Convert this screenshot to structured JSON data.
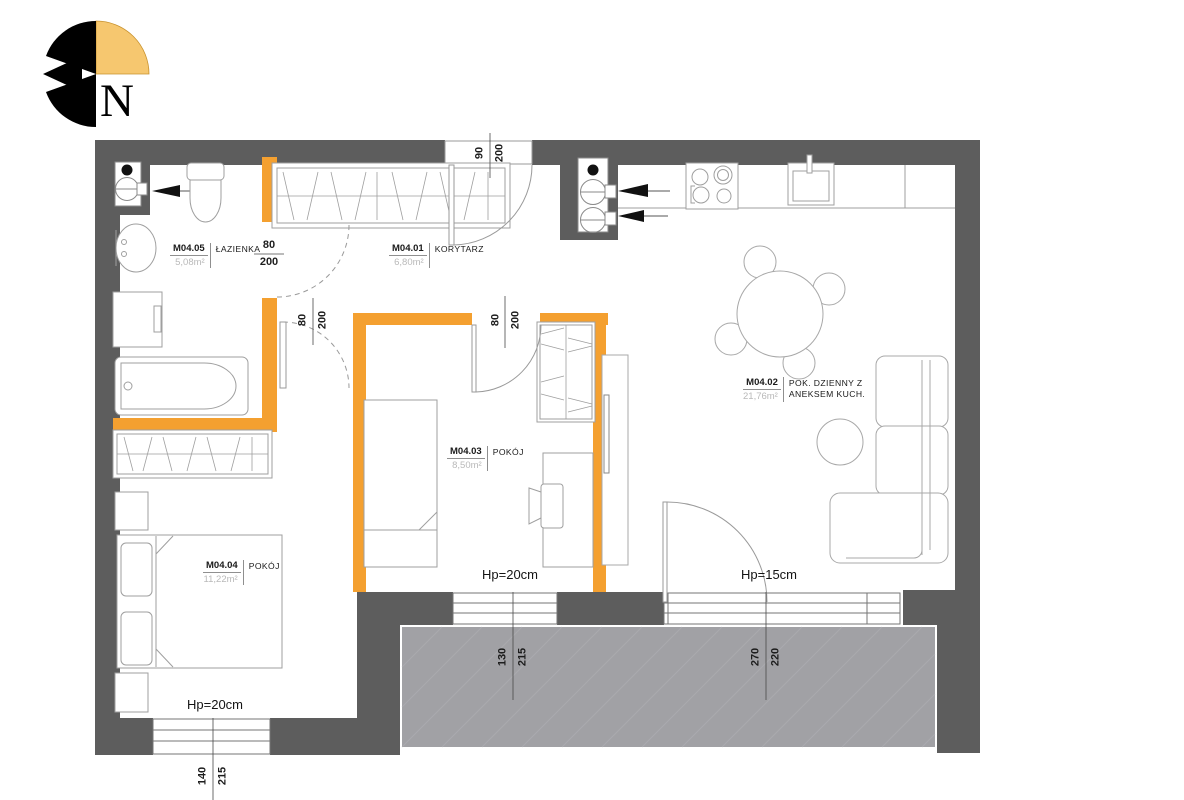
{
  "compass": {
    "label": "N"
  },
  "rooms": {
    "bathroom": {
      "id": "M04.05",
      "area": "5,08m²",
      "name": "ŁAZIENKA"
    },
    "corridor": {
      "id": "M04.01",
      "area": "6,80m²",
      "name": "KORYTARZ"
    },
    "room_small": {
      "id": "M04.03",
      "area": "8,50m²",
      "name": "POKÓJ"
    },
    "bedroom": {
      "id": "M04.04",
      "area": "11,22m²",
      "name": "POKÓJ"
    },
    "living": {
      "id": "M04.02",
      "area": "21,76m²",
      "name_line1": "POK. DZIENNY Z",
      "name_line2": "ANEKSEM KUCH."
    }
  },
  "openings": {
    "entrance_door": {
      "width": "90",
      "height": "200"
    },
    "bathroom_door": {
      "width": "80",
      "height": "200"
    },
    "bedroom_door": {
      "width": "80",
      "height": "200"
    },
    "small_room_door": {
      "width": "80",
      "height": "200"
    },
    "window_small_room": {
      "width": "130",
      "height": "215"
    },
    "balcony_door": {
      "width": "270",
      "height": "220"
    },
    "window_bedroom": {
      "width": "140",
      "height": "215"
    }
  },
  "sills": {
    "small_room": "Hp=20cm",
    "living": "Hp=15cm",
    "bedroom": "Hp=20cm"
  },
  "colors": {
    "wall": "#5d5d5d",
    "partition": "#f4a030",
    "balcony": "#a1a1a5",
    "compass_quarter": "#f6c76f"
  }
}
